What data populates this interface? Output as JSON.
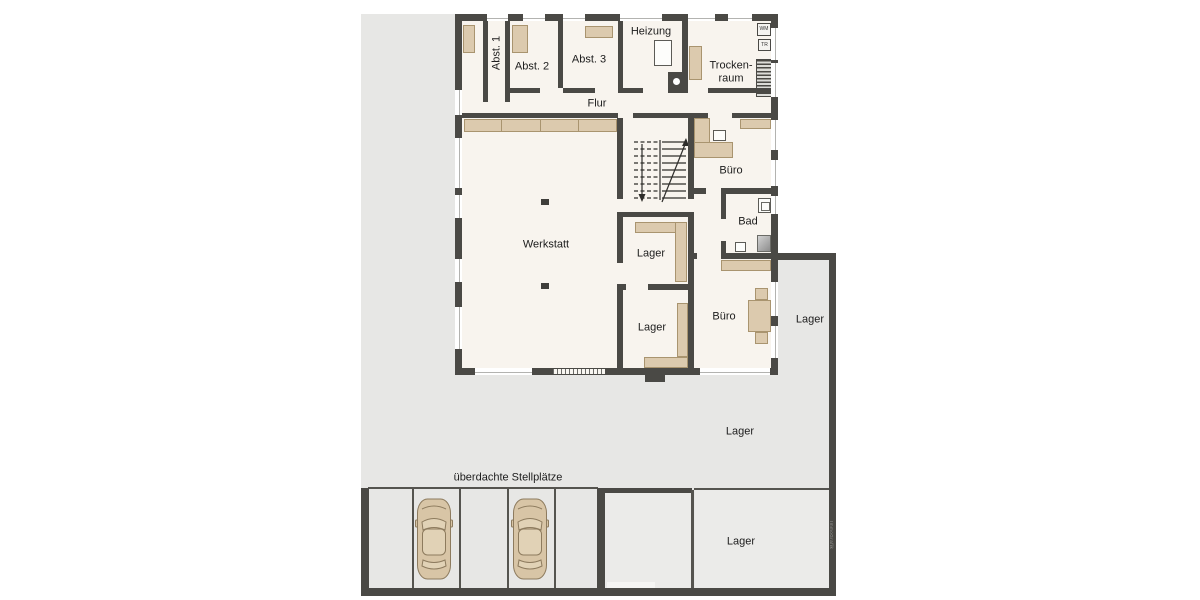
{
  "labels": {
    "abst1": "Abst. 1",
    "abst2": "Abst. 2",
    "abst3": "Abst. 3",
    "heizung": "Heizung",
    "trockenraum1": "Trocken-",
    "trockenraum2": "raum",
    "flur": "Flur",
    "werkstatt": "Werkstatt",
    "buero_top": "Büro",
    "bad": "Bad",
    "lager_upper": "Lager",
    "lager_lower": "Lager",
    "buero_lower": "Büro",
    "lager_side": "Lager",
    "lager_yard": "Lager",
    "lager_south": "Lager",
    "wm": "WM",
    "tr": "TR",
    "carport": "überdachte Stellplätze",
    "watermark": "ImmoGrafik"
  },
  "carport": {
    "spaces": 5,
    "cars_parked": 2
  },
  "colors": {
    "wall": "#4a4945",
    "room_floor": "#f8f4ee",
    "lot_gray": "#e7e7e5",
    "gray_room": "#ebebe9",
    "furniture": "#dccaae",
    "car": "#d8c5a6"
  }
}
